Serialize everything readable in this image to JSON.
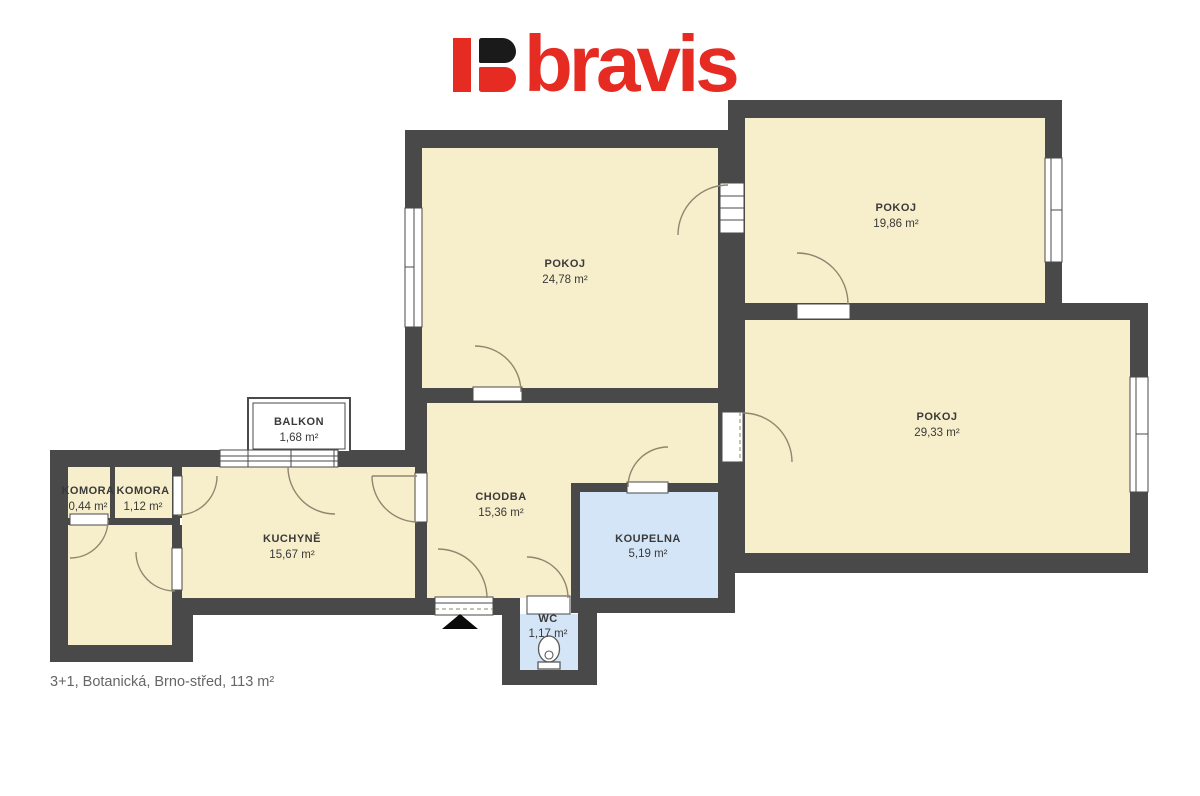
{
  "brand": {
    "name": "bravis"
  },
  "caption": "3+1, Botanická, Brno-střed, 113 m²",
  "colors": {
    "wall": "#494949",
    "room_fill": "#f7eecb",
    "wet_room_fill": "#d3e5f6",
    "logo_red": "#e62b22",
    "logo_black": "#1a1a1a",
    "label_text": "#3a3a3a",
    "caption_text": "#666666"
  },
  "rooms": [
    {
      "name": "POKOJ",
      "area": "24,78 m²"
    },
    {
      "name": "POKOJ",
      "area": "19,86 m²"
    },
    {
      "name": "POKOJ",
      "area": "29,33 m²"
    },
    {
      "name": "BALKON",
      "area": "1,68 m²"
    },
    {
      "name": "KOMORA",
      "area": "0,44 m²"
    },
    {
      "name": "KOMORA",
      "area": "1,12 m²"
    },
    {
      "name": "KUCHYNĚ",
      "area": "15,67 m²"
    },
    {
      "name": "CHODBA",
      "area": "15,36 m²"
    },
    {
      "name": "KOUPELNA",
      "area": "5,19 m²"
    },
    {
      "name": "WC",
      "area": "1,17 m²"
    }
  ]
}
